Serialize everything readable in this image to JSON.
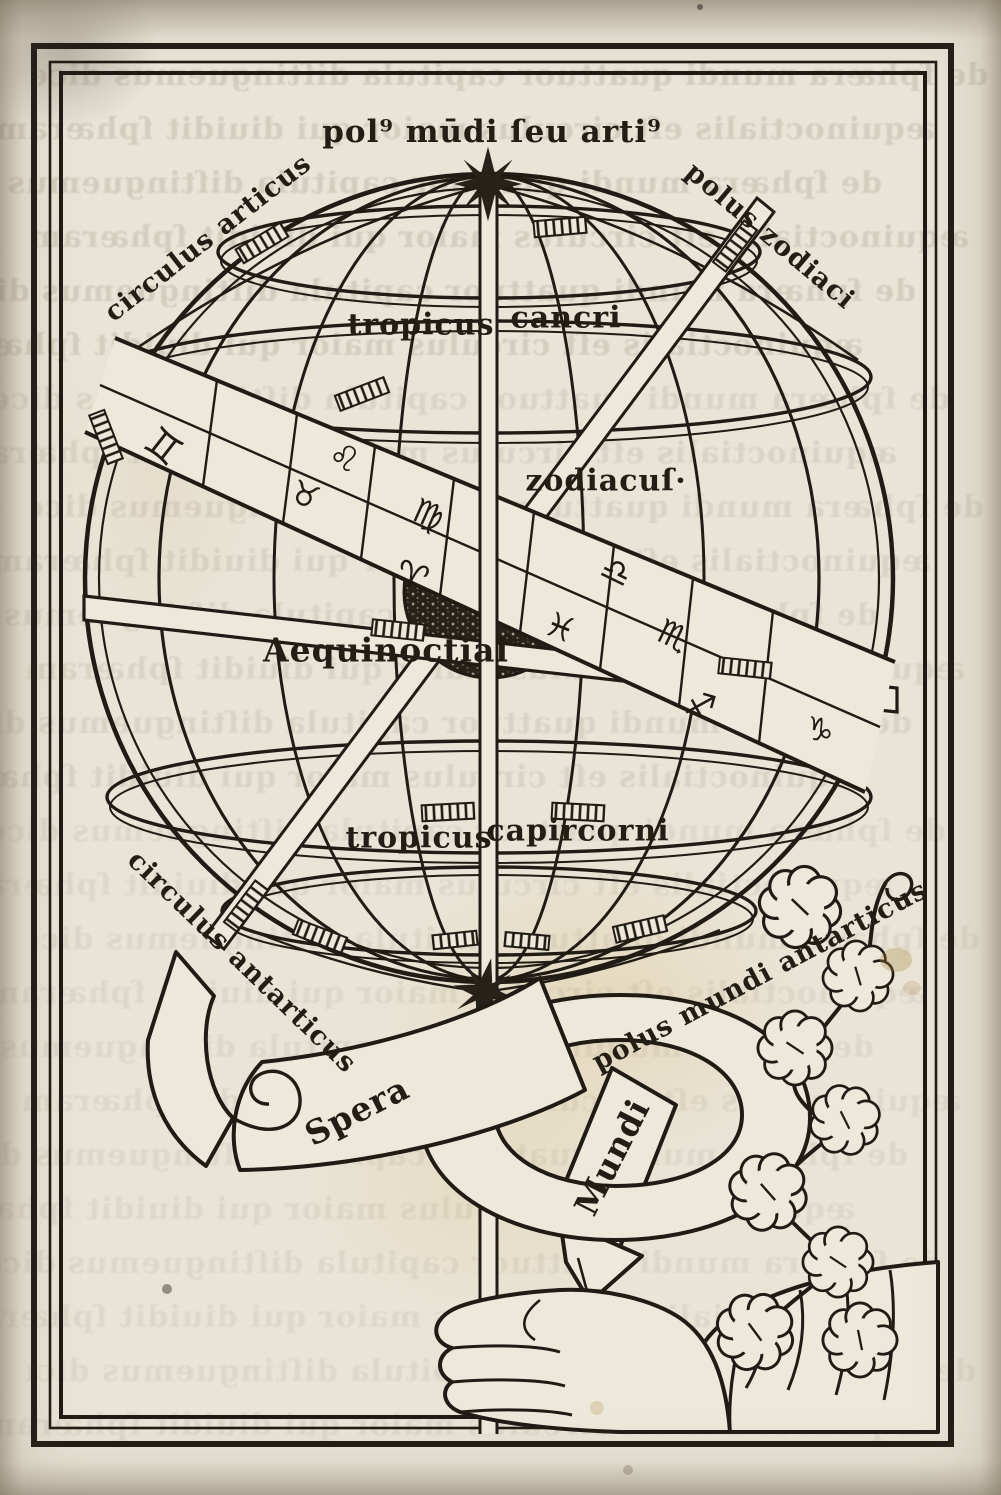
{
  "document": {
    "kind": "early printed book page (incunabulum) with woodcut diagram",
    "subject": "armillary sphere — Sphera Mundi",
    "paper_color": "#e9e4d6",
    "ink_color": "#201c15"
  },
  "labels": {
    "pole_north": "pol⁹ mūdi ſeu arti⁹",
    "circle_arctic": "circulus articus",
    "pole_zodiac": "polus zodiaci",
    "tropic_cancer_word1": "tropicus",
    "tropic_cancer_word2": "cancri",
    "zodiac_ring": "zodiacuſ·",
    "equinoctial": "Aequinoctiaľ",
    "tropic_capricorn_word1": "tropicus",
    "tropic_capricorn_word2": "capircorni",
    "circle_antarctic": "circulus antarticus",
    "pole_south": "polus mundi antarticus",
    "banner_word1": "Spera",
    "banner_word2": "Mundi"
  },
  "zodiac_band": {
    "symbols": [
      {
        "name": "gemini",
        "glyph": "♊",
        "x": 163,
        "y": 447,
        "rot": 38,
        "size": 40
      },
      {
        "name": "leo",
        "glyph": "♌",
        "x": 344,
        "y": 458,
        "rot": 24,
        "size": 34
      },
      {
        "name": "taurus",
        "glyph": "♉",
        "x": 305,
        "y": 495,
        "rot": 22,
        "size": 32
      },
      {
        "name": "virgo",
        "glyph": "♍",
        "x": 428,
        "y": 515,
        "rot": 24,
        "size": 34
      },
      {
        "name": "aries",
        "glyph": "♈",
        "x": 412,
        "y": 577,
        "rot": 18,
        "size": 36
      },
      {
        "name": "libra",
        "glyph": "♎",
        "x": 616,
        "y": 572,
        "rot": 26,
        "size": 34
      },
      {
        "name": "pisces",
        "glyph": "♓",
        "x": 560,
        "y": 628,
        "rot": 22,
        "size": 34
      },
      {
        "name": "scorpio",
        "glyph": "♏",
        "x": 673,
        "y": 636,
        "rot": 26,
        "size": 34
      },
      {
        "name": "sagittarius",
        "glyph": "♐",
        "x": 700,
        "y": 706,
        "rot": 16,
        "size": 34
      },
      {
        "name": "capricorn",
        "glyph": "♑",
        "x": 820,
        "y": 730,
        "rot": 12,
        "size": 32
      }
    ]
  },
  "bleedthrough": {
    "note": "illegible blackletter text showing through from the reverse side of the leaf",
    "line_a": "de ſphæra mundi quattuor capitula diſtinguemus dicendo primo quid ſit ſphæra quid centrum eius quid axis",
    "line_b": "æquinoctialis eſt circulus maior qui diuidit ſphæram in duo media ſecundum quemlibet ſitum zodiaci poli"
  }
}
